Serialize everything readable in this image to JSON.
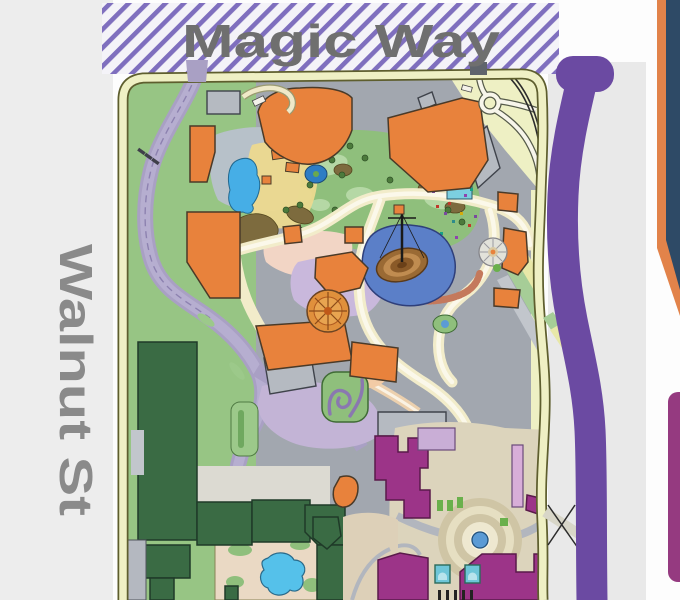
{
  "streets": {
    "magic_way": {
      "label": "Magic Way",
      "orientation": "horizontal",
      "surface": "purple-hatched-band"
    },
    "walnut_st": {
      "label": "Walnut St",
      "orientation": "vertical",
      "surface": "gray-band"
    }
  },
  "map": {
    "kind": "illustrated theme park map, northwest corner",
    "landmark_shapes": [
      "toontown-pond",
      "central-lagoon-with-ship",
      "carousel",
      "teacups-rosette",
      "hub-fountain",
      "kiddie-pool",
      "ne-entry-loop"
    ]
  },
  "palette": {
    "street_label_gray": "#6f6f6f",
    "walnut_label_gray": "#8a8a8a",
    "hatch_stripe_purple": "#7f6fbe",
    "hatch_bg": "#f4f3f8",
    "sidewalk_gray": "#ededed",
    "right_gray": "#e9e9e9",
    "berm_cream": "#eff0c4",
    "berm_edge_olive": "#5e5e2e",
    "lawn_green": "#97c584",
    "pavement_gray": "#a2a7af",
    "toontown_pavement": "#b7c1c9",
    "toontown_path_yellow": "#ecd98f",
    "garden_green": "#8fbf7c",
    "building_orange": "#e8823c",
    "building_gray": "#b5bac1",
    "building_dark_green": "#3a6b44",
    "building_magenta": "#9c3488",
    "water_blue": "#46aee6",
    "lagoon_blue": "#5b7fc8",
    "pool_cyan": "#55c1ea",
    "hub_blue": "#5b9bd5",
    "path_cream": "#f2ecca",
    "road_lavender": "#a9a0c4",
    "road_purple": "#6b4aa2",
    "card_navy": "#2e4a66",
    "card_orange": "#e2834a",
    "card_magenta": "#953a80"
  }
}
